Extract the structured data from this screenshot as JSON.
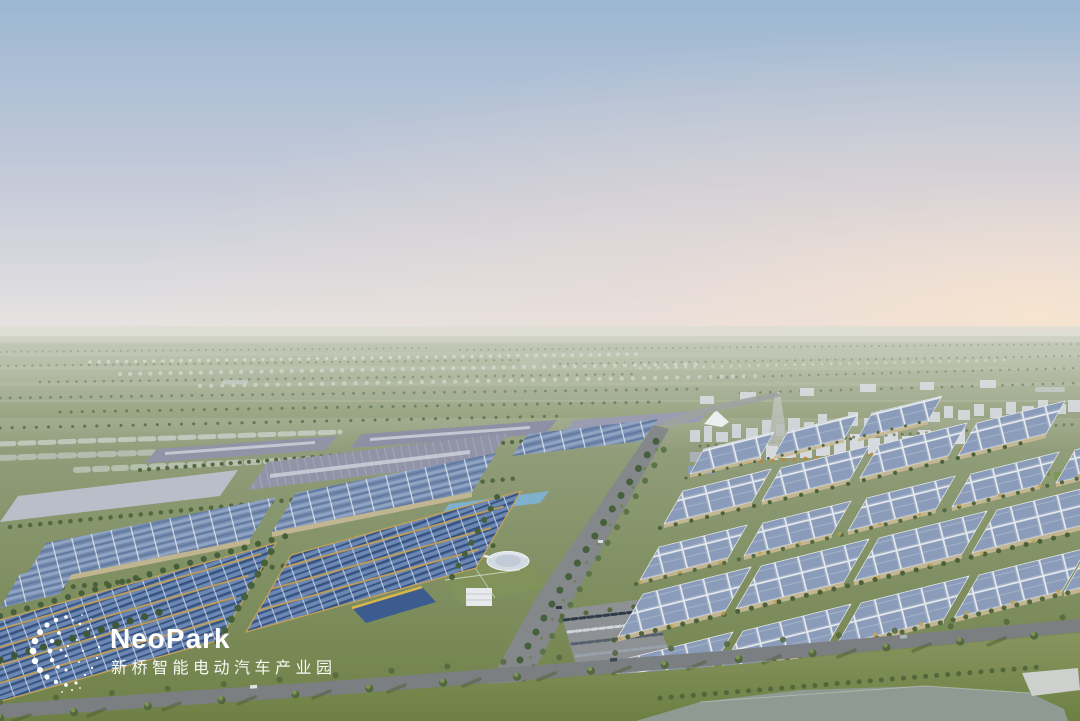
{
  "page": {
    "title": "NeoPark aerial rendering"
  },
  "logo": {
    "name": "NeoPark",
    "subtitle": "新桥智能电动汽车产业园",
    "icon": "dot-swirl-logo-icon",
    "color": "#ffffff"
  },
  "scene": {
    "type": "aerial-architectural-rendering",
    "time_of_day": "dusk",
    "features": [
      "hazy sky with warm sunset glow on the right",
      "flat farmland horizon",
      "distant low-rise city blocks and residential towers",
      "white tent-roof landmark pavilion",
      "large factory halls with rooftop solar panels",
      "grid of warehouses with solar roofs and tree-lined streets",
      "tree-lined boulevard running into the distance",
      "parking lot with rows of cars",
      "foreground road with street trees and long shadows",
      "lawn and pond in the foreground"
    ]
  },
  "colors": {
    "sky_top": "#9cb7d3",
    "sky_mid": "#c6cbd9",
    "sky_horizon": "#e9e5e2",
    "sunset_glow": "#f7e4cf",
    "farmland_light": "#a4ac93",
    "farmland": "#8e9b77",
    "grass_deep": "#6f8147",
    "grass_light": "#87965f",
    "grass_dark": "#6d7f44",
    "tree_green": "#53683f",
    "tree_dark": "#46603c",
    "tree_yellow": "#c2a352",
    "tree_orange": "#b9873f",
    "blossom": "#ccd3c9",
    "solar_deep": "#476392",
    "solar_mid": "#7288ad",
    "solar_pale": "#a3b2c7",
    "roof_violet": "#9193a7",
    "roof_light": "#b9bec9",
    "roof_teal": "#7fb0cd",
    "wall_beige": "#c8b996",
    "gold_trim": "#c3a159",
    "road": "#84888b",
    "road_dark": "#7b7f82",
    "water": "#8e9a92",
    "city_far": "#cdd2d7",
    "city_near": "#d6d9de",
    "logo_white": "#ffffff"
  }
}
